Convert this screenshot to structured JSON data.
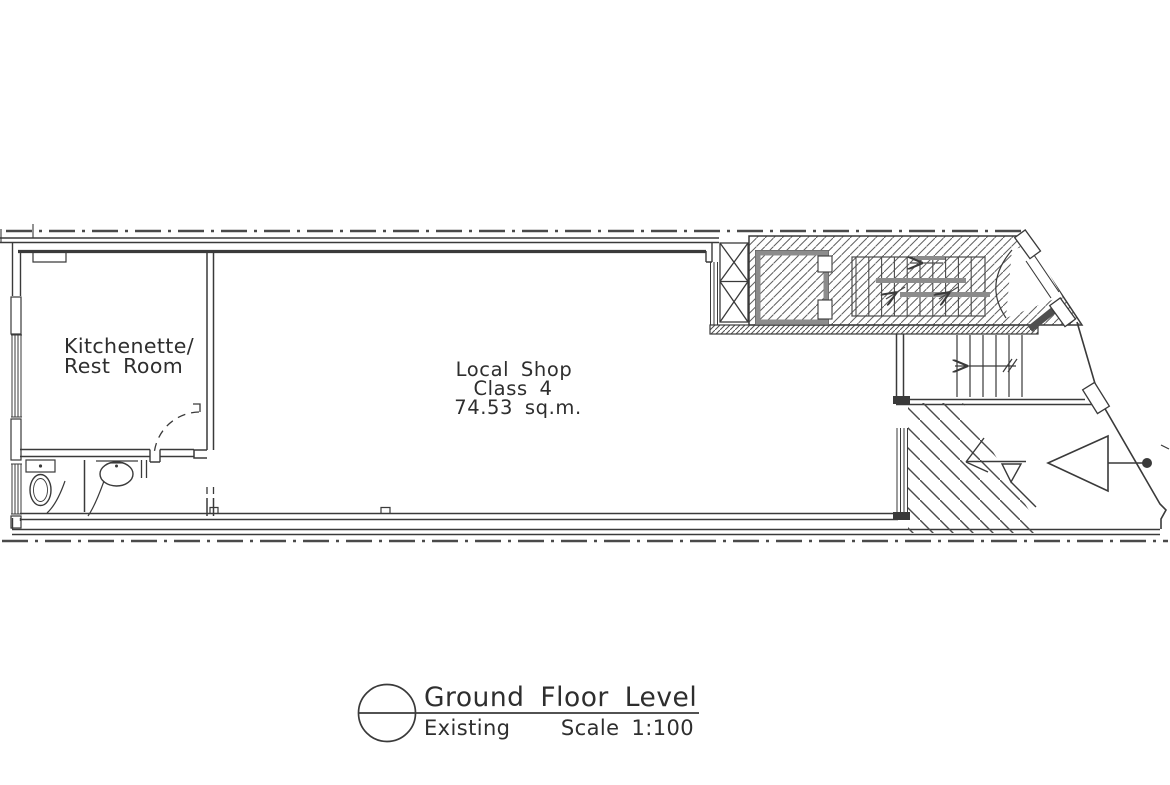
{
  "plan": {
    "kitchenette": {
      "line1": "Kitchenette/",
      "line2": "Rest Room"
    },
    "shop": {
      "line1": "Local Shop",
      "line2": "Class 4",
      "line3": "74.53 sq.m."
    },
    "title_block": {
      "heading": "Ground Floor Level",
      "status": "Existing",
      "scale": "Scale 1:100"
    }
  },
  "colors": {
    "line": "#3a3a3a",
    "thin_line": "#4a4a4a",
    "hatch": "#5f5f5f",
    "grey_fixture": "#8c8c8c",
    "text": "#2e2e2e",
    "background": "#ffffff"
  }
}
